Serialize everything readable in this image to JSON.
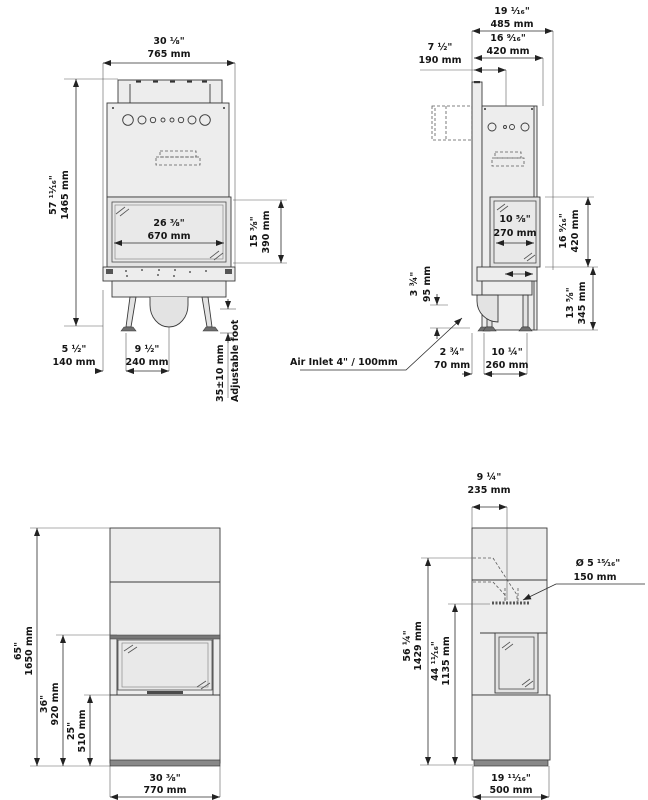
{
  "title": "Fireplace technical dimension drawing",
  "units": {
    "primary": "inches",
    "secondary": "millimetres"
  },
  "colors": {
    "line": "#3a3a3a",
    "fill_light": "#ededed",
    "fill_glass": "#e9e9e9",
    "dark_strip": "#6e6e6e",
    "text": "#151515",
    "background": "#ffffff"
  },
  "views": {
    "front": {
      "label": "insert front view",
      "dims": {
        "overall_width": {
          "in": "30 ⅛\"",
          "mm": "765 mm"
        },
        "overall_height": {
          "in": "57 ¹¹⁄₁₆\"",
          "mm": "1465 mm"
        },
        "glass_width": {
          "in": "26 ⅜\"",
          "mm": "670 mm"
        },
        "glass_height": {
          "in": "15 ⅜\"",
          "mm": "390 mm"
        },
        "foot_inset": {
          "in": "5 ½\"",
          "mm": "140 mm"
        },
        "foot_spacing": {
          "in": "9 ½\"",
          "mm": "240 mm"
        },
        "adjustable_foot": {
          "range": "35±10 mm",
          "label": "Adjustable foot"
        }
      }
    },
    "side": {
      "label": "insert side view",
      "dims": {
        "overall_depth": {
          "in": "19 ¹⁄₁₆\"",
          "mm": "485 mm"
        },
        "body_depth": {
          "in": "16 ⁹⁄₁₆\"",
          "mm": "420 mm"
        },
        "top_depth": {
          "in": "7 ½\"",
          "mm": "190 mm"
        },
        "side_glass_width": {
          "in": "10 ⅝\"",
          "mm": "270 mm"
        },
        "side_glass_height": {
          "in": "16 ⁹⁄₁₆\"",
          "mm": "420 mm"
        },
        "base_height": {
          "in": "13 ⅝\"",
          "mm": "345 mm"
        },
        "inlet_clearance": {
          "in": "3 ¾\"",
          "mm": "95 mm"
        },
        "air_inlet": {
          "label": "Air Inlet 4\" / 100mm"
        },
        "front_foot_offset": {
          "in": "2 ¾\"",
          "mm": "70 mm"
        },
        "foot_spacing": {
          "in": "10 ¼\"",
          "mm": "260 mm"
        }
      }
    },
    "surround_front": {
      "label": "surround front view",
      "dims": {
        "overall_height": {
          "in": "65\"",
          "mm": "1650 mm"
        },
        "opening_top": {
          "in": "36\"",
          "mm": "920 mm"
        },
        "opening_bottom": {
          "in": "25\"",
          "mm": "510 mm"
        },
        "overall_width": {
          "in": "30 ⅜\"",
          "mm": "770 mm"
        }
      }
    },
    "surround_side": {
      "label": "surround side view",
      "dims": {
        "flue_offset": {
          "in": "9 ¼\"",
          "mm": "235 mm"
        },
        "flue_diameter": {
          "in": "Ø 5 ¹⁵⁄₁₆\"",
          "mm": "150 mm"
        },
        "flue_height": {
          "in": "56 ¼\"",
          "mm": "1429 mm"
        },
        "firebox_top_height": {
          "in": "44 ¹¹⁄₁₆\"",
          "mm": "1135 mm"
        },
        "overall_depth": {
          "in": "19 ¹¹⁄₁₆\"",
          "mm": "500 mm"
        }
      }
    }
  }
}
